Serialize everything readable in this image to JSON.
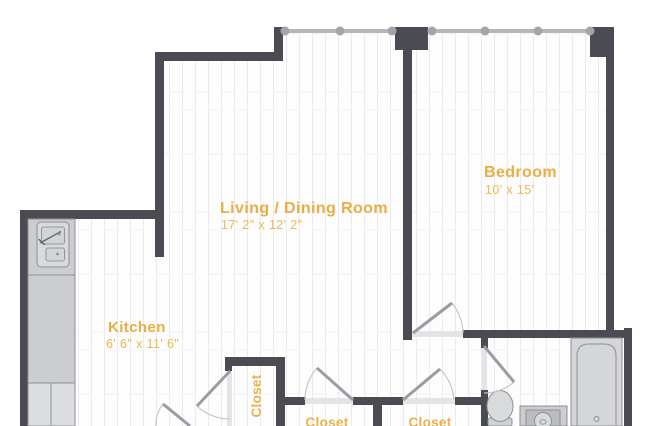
{
  "plan": {
    "type": "apartment-floor-plan",
    "rooms": {
      "living": {
        "name": "Living / Dining Room",
        "dims": "17' 2\" x 12' 2\""
      },
      "bedroom": {
        "name": "Bedroom",
        "dims": "10' x 15'"
      },
      "kitchen": {
        "name": "Kitchen",
        "dims": "6' 6\" x 11' 6\""
      },
      "closet_hall": {
        "name": "Closet"
      },
      "closet_left": {
        "name": "Closet"
      },
      "closet_right": {
        "name": "Closet"
      }
    },
    "fixtures": [
      "kitchen-counter",
      "kitchen-sink",
      "toilet",
      "vanity-sink",
      "bathtub",
      "windows-with-mullions",
      "swing-doors"
    ],
    "colors": {
      "wall": "#4b4c53",
      "room_label": "#e9ad42",
      "room_dims": "#edb84e",
      "window_line": "#b6b7bc",
      "fixture_outline": "#8e8f94",
      "fixture_fill": "#cbcdd0",
      "floor": "#fdfdfe",
      "plank_line": "#eaebee"
    }
  }
}
